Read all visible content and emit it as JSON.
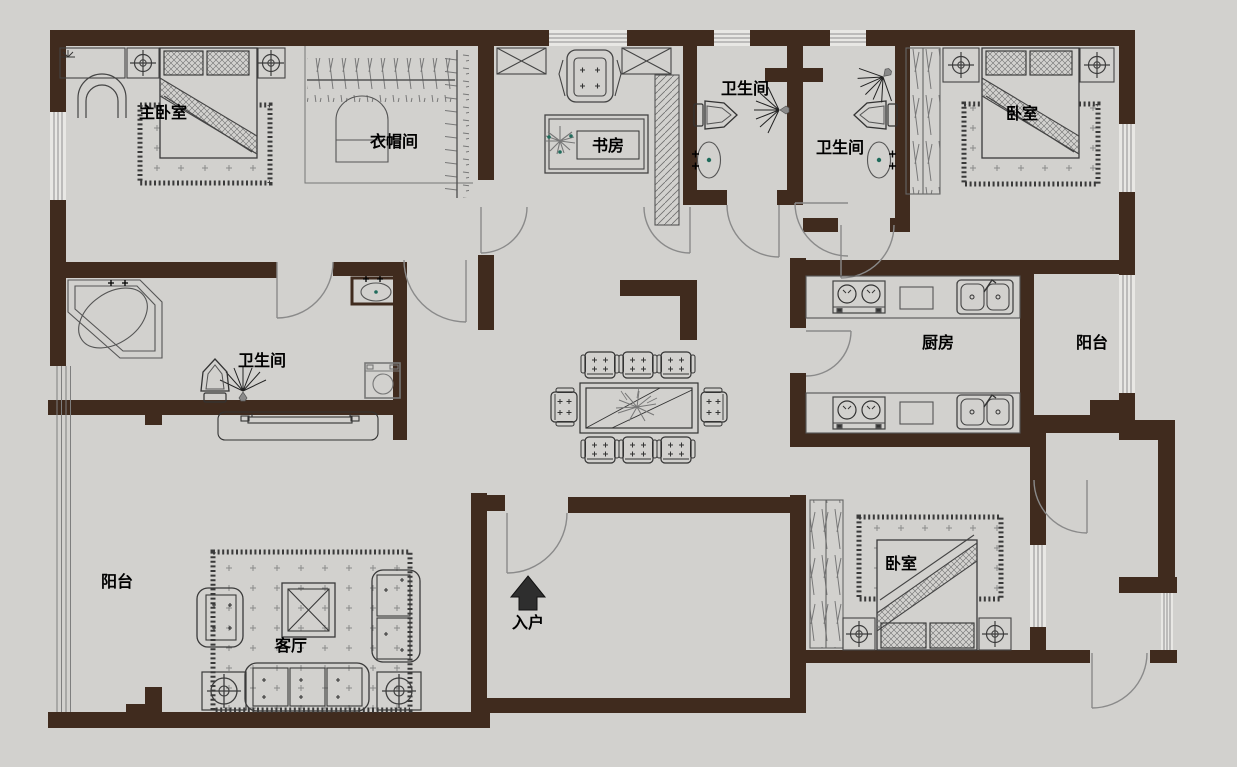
{
  "app": {
    "type": "apartment-floor-plan",
    "orientation_arrow": "up"
  },
  "colors": {
    "wall": "#402b1e",
    "floor": "#d2d1ce",
    "furniture_line": "#4a4a4a",
    "door_line": "#8a8a8a",
    "window_line": "#8f8f8f",
    "label_text": "#000000",
    "fixture_accent": "#1f6b5b",
    "entry_arrow": "#2e2e2e"
  },
  "rooms": [
    {
      "id": "master-bedroom",
      "label": "主卧室"
    },
    {
      "id": "cloakroom",
      "label": "衣帽间"
    },
    {
      "id": "study",
      "label": "书房"
    },
    {
      "id": "bathroom-top-1",
      "label": "卫生间"
    },
    {
      "id": "bathroom-top-2",
      "label": "卫生间"
    },
    {
      "id": "bedroom-top-right",
      "label": "卧室"
    },
    {
      "id": "master-bathroom",
      "label": "卫生间"
    },
    {
      "id": "kitchen",
      "label": "厨房"
    },
    {
      "id": "balcony-right",
      "label": "阳台"
    },
    {
      "id": "balcony-left",
      "label": "阳台"
    },
    {
      "id": "living-room",
      "label": "客厅"
    },
    {
      "id": "bedroom-bottom",
      "label": "卧室"
    },
    {
      "id": "entry",
      "label": "入户"
    }
  ],
  "fixtures": [
    "double-bed",
    "pillows",
    "area-rug",
    "nightstand-ceiling-lamp",
    "dresser",
    "vanity-chair",
    "clothes-rail",
    "wardrobe",
    "desk",
    "desk-chair",
    "bookshelf",
    "potted-plant",
    "toilet",
    "wash-basin",
    "shower-head",
    "corner-bathtub",
    "washing-machine",
    "dining-table",
    "dining-chair",
    "gas-stove",
    "kitchen-sink",
    "counter",
    "sofa",
    "armchair",
    "coffee-table",
    "end-table",
    "tv-console",
    "entry-arrow"
  ]
}
